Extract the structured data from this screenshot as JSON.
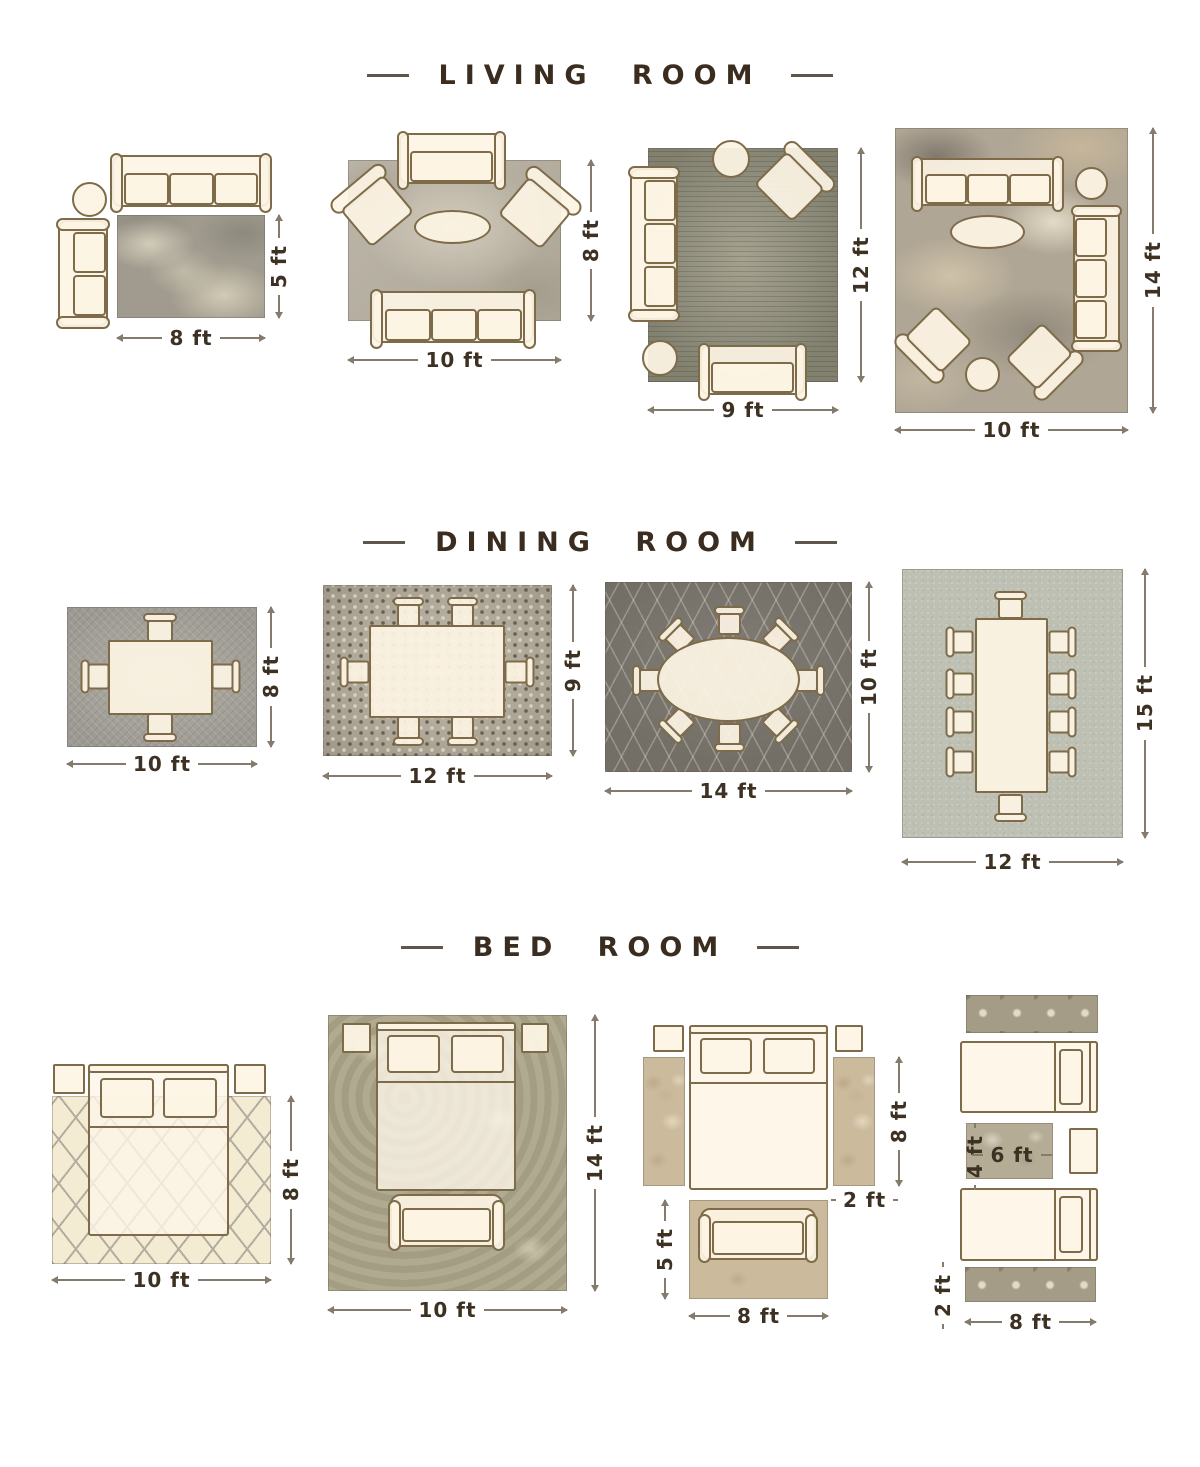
{
  "infographic": {
    "colors": {
      "title_text": "#3a2d20",
      "furniture_fill": "#fdf4e4",
      "furniture_outline": "#7d6b4a",
      "dimension_text": "#3c3122",
      "dimension_line": "#847b6d"
    },
    "sections": [
      {
        "title": "LIVING ROOM",
        "layouts": [
          {
            "name": "sofa-and-loveseat-off-rug",
            "width": "8 ft",
            "height": "5 ft"
          },
          {
            "name": "front-legs-on-rug",
            "width": "10 ft",
            "height": "8 ft"
          },
          {
            "name": "seating-on-rug-edges",
            "width": "9 ft",
            "height": "12 ft"
          },
          {
            "name": "all-furniture-on-rug",
            "width": "10 ft",
            "height": "14 ft"
          }
        ]
      },
      {
        "title": "DINING ROOM",
        "layouts": [
          {
            "name": "table-4-chairs",
            "width": "10 ft",
            "height": "8 ft"
          },
          {
            "name": "table-6-chairs",
            "width": "12 ft",
            "height": "9 ft"
          },
          {
            "name": "oval-table-8-chairs",
            "width": "14 ft",
            "height": "10 ft"
          },
          {
            "name": "long-table-10-chairs",
            "width": "12 ft",
            "height": "15 ft"
          }
        ]
      },
      {
        "title": "BED ROOM",
        "layouts": [
          {
            "name": "bed-top-off-rug",
            "width": "10 ft",
            "height": "8 ft"
          },
          {
            "name": "bed-fully-on-rug",
            "width": "10 ft",
            "height": "14 ft"
          },
          {
            "name": "runners-beside-bed",
            "width": "8 ft",
            "height": "5 ft",
            "runner_length": "8 ft",
            "runner_width": "2 ft"
          },
          {
            "name": "twin-beds-runners",
            "width": "8 ft",
            "runner_width": "2 ft",
            "accent_width": "6 ft",
            "accent_height": "4 ft"
          }
        ]
      }
    ]
  }
}
